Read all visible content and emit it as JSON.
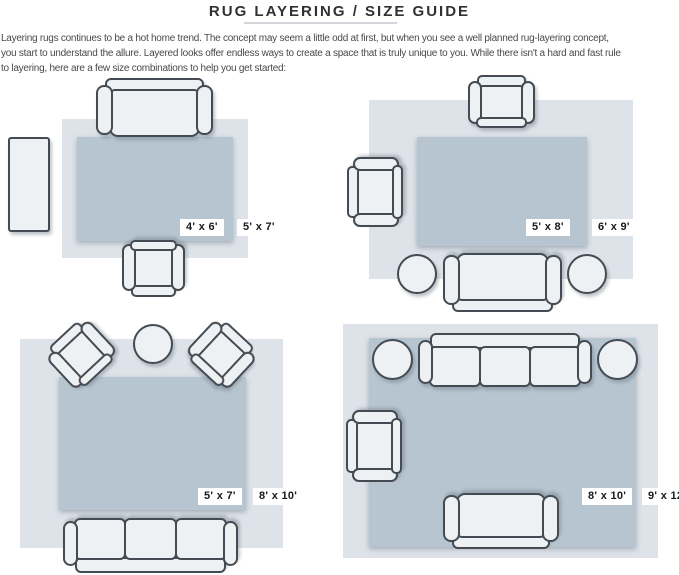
{
  "page": {
    "title": "RUG LAYERING / SIZE GUIDE",
    "intro_lines": [
      "Layering rugs continues to be a hot home trend. The concept may seem a little odd at first, but when you see a well planned rug-layering concept,",
      "you start to understand the allure. Layered looks offer endless ways to create a space that is truly unique to you. While there isn't a hard and fast rule",
      "to layering, here are a few size combinations to help you get started:"
    ]
  },
  "colors": {
    "outer_rug": "#dde3e9",
    "inner_rug": "#b7c5d1",
    "furniture_fill": "#eef1f3",
    "furniture_outline": "#454b52",
    "label_bg": "#ffffff",
    "label_text": "#17191c",
    "title_text": "#2f3133",
    "body_text": "#48494b",
    "divider": "#d2d6da"
  },
  "layouts": [
    {
      "name": "top-left",
      "inner_rug_size": "4' x 6'",
      "outer_rug_size": "5' x 7'",
      "furniture": [
        "loveseat-sofa",
        "console-table",
        "armchair"
      ]
    },
    {
      "name": "top-right",
      "inner_rug_size": "5' x 8'",
      "outer_rug_size": "6' x 9'",
      "furniture": [
        "armchair",
        "armchair",
        "loveseat-sofa",
        "round-side-table",
        "round-side-table"
      ]
    },
    {
      "name": "bottom-left",
      "inner_rug_size": "5' x 7'",
      "outer_rug_size": "8' x 10'",
      "furniture": [
        "armchair",
        "armchair",
        "round-side-table",
        "three-seat-sofa"
      ]
    },
    {
      "name": "bottom-right",
      "inner_rug_size": "8' x 10'",
      "outer_rug_size": "9' x 12'",
      "furniture": [
        "three-seat-sofa",
        "round-side-table",
        "round-side-table",
        "armchair",
        "loveseat-sofa"
      ]
    }
  ]
}
